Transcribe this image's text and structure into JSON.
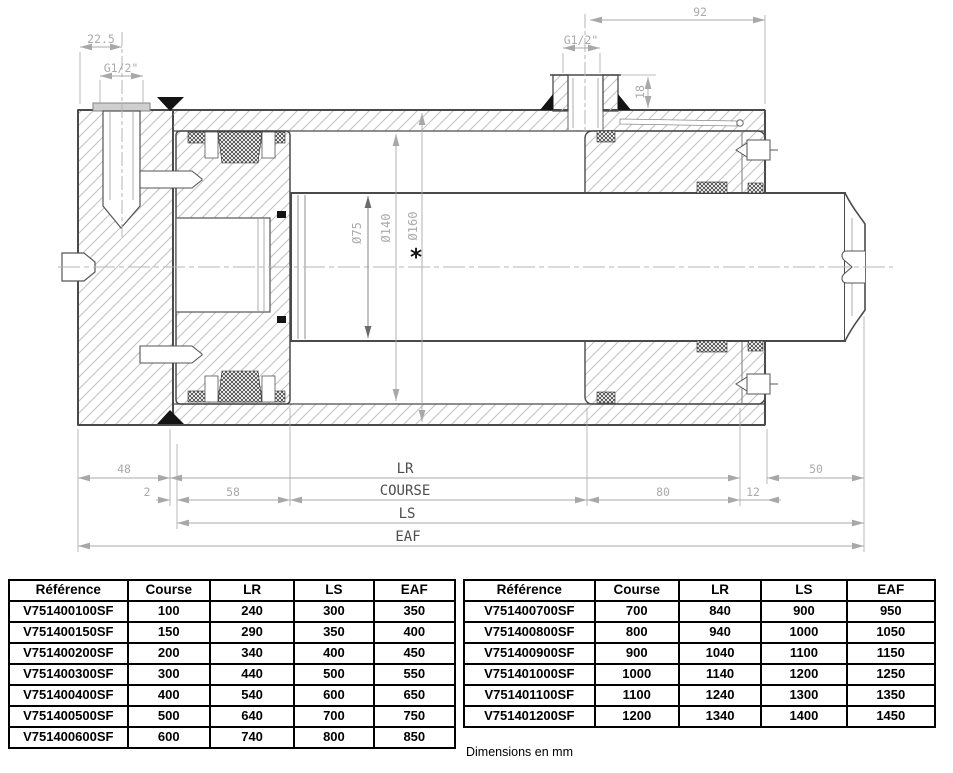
{
  "drawing": {
    "labels": {
      "dim_22_5": "22.5",
      "g12_left": "G1/2\"",
      "dim_92": "92",
      "g12_top": "G1/2\"",
      "dim_18": "18",
      "dia_75": "Ø75",
      "dia_140": "Ø140",
      "dia_160": "Ø160",
      "star": "*",
      "dim_48": "48",
      "dim_2": "2",
      "dim_58": "58",
      "dim_lr": "LR",
      "dim_course": "COURSE",
      "dim_ls": "LS",
      "dim_eaf": "EAF",
      "dim_80": "80",
      "dim_12": "12",
      "dim_50": "50"
    },
    "colors": {
      "outline": "#4a4a4a",
      "hatch": "#c2c2c2",
      "dimension": "#a8a8a8",
      "seal": "#1a1a1a"
    }
  },
  "tables": {
    "left": {
      "headers": [
        "Référence",
        "Course",
        "LR",
        "LS",
        "EAF"
      ],
      "rows": [
        [
          "V751400100SF",
          "100",
          "240",
          "300",
          "350"
        ],
        [
          "V751400150SF",
          "150",
          "290",
          "350",
          "400"
        ],
        [
          "V751400200SF",
          "200",
          "340",
          "400",
          "450"
        ],
        [
          "V751400300SF",
          "300",
          "440",
          "500",
          "550"
        ],
        [
          "V751400400SF",
          "400",
          "540",
          "600",
          "650"
        ],
        [
          "V751400500SF",
          "500",
          "640",
          "700",
          "750"
        ],
        [
          "V751400600SF",
          "600",
          "740",
          "800",
          "850"
        ]
      ]
    },
    "right": {
      "headers": [
        "Référence",
        "Course",
        "LR",
        "LS",
        "EAF"
      ],
      "rows": [
        [
          "V751400700SF",
          "700",
          "840",
          "900",
          "950"
        ],
        [
          "V751400800SF",
          "800",
          "940",
          "1000",
          "1050"
        ],
        [
          "V751400900SF",
          "900",
          "1040",
          "1100",
          "1150"
        ],
        [
          "V751401000SF",
          "1000",
          "1140",
          "1200",
          "1250"
        ],
        [
          "V751401100SF",
          "1100",
          "1240",
          "1300",
          "1350"
        ],
        [
          "V751401200SF",
          "1200",
          "1340",
          "1400",
          "1450"
        ]
      ]
    },
    "footnote": "Dimensions en mm"
  }
}
